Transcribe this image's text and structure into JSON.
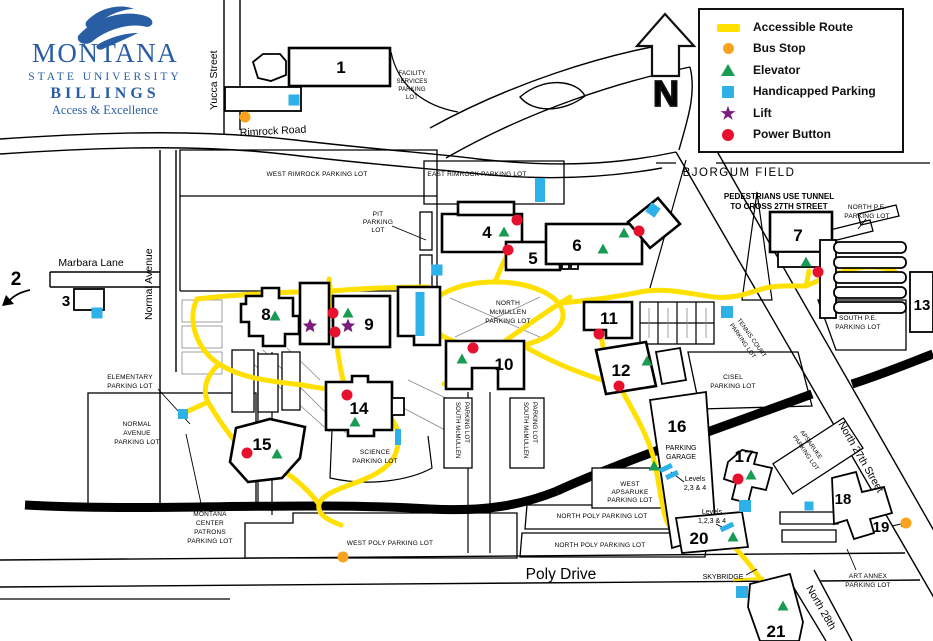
{
  "colors": {
    "route_yellow": "#FFE000",
    "bus_orange": "#F7A31C",
    "elevator_green": "#1A9B53",
    "handicap_blue": "#2EB1E8",
    "lift_purple": "#7A1B7E",
    "power_red": "#E8112D",
    "logo_blue": "#2A5EA4"
  },
  "logo": {
    "line1": "MONTANA",
    "line2": "STATE UNIVERSITY",
    "line3": "BILLINGS",
    "tagline": "Access & Excellence"
  },
  "compass": {
    "label": "N"
  },
  "legend": {
    "items": [
      {
        "icon": "accessible-route-swatch",
        "label": "Accessible Route"
      },
      {
        "icon": "bus-stop-dot",
        "label": "Bus Stop"
      },
      {
        "icon": "elevator-triangle",
        "label": "Elevator"
      },
      {
        "icon": "handicapped-parking-square",
        "label": "Handicapped Parking"
      },
      {
        "icon": "lift-star",
        "label": "Lift"
      },
      {
        "icon": "power-button-dot",
        "label": "Power Button"
      }
    ]
  },
  "streets": {
    "yucca": "Yucca Street",
    "rimrock": "Rimrock Road",
    "normal": "Normal Avenue",
    "marbara": "Marbara Lane",
    "poly": "Poly Drive",
    "n27": "North 27th Street",
    "n28": "North 28th"
  },
  "labels": {
    "bjorgum": "BJORGUM FIELD",
    "tunnel": [
      "PEDESTRIANS USE TUNNEL",
      "TO CROSS 27TH STREET"
    ],
    "skybridge": "SKYBRIDGE",
    "garage": [
      "PARKING",
      "GARAGE"
    ],
    "levels234": [
      "Levels",
      "2,3 & 4"
    ],
    "levels1234": [
      "Levels",
      "1,2,3 & 4"
    ]
  },
  "lots": {
    "west_rimrock": [
      "WEST RIMROCK PARKING LOT"
    ],
    "east_rimrock": [
      "EAST RIMROCK PARKING LOT"
    ],
    "facility": [
      "FACILITY",
      "SERVICES",
      "PARKING",
      "LOT"
    ],
    "pit": [
      "PIT",
      "PARKING",
      "LOT"
    ],
    "north_pe": [
      "NORTH P.E.",
      "PARKING LOT"
    ],
    "south_pe": [
      "SOUTH P.E.",
      "PARKING LOT"
    ],
    "north_mcmullen": [
      "NORTH",
      "McMULLEN",
      "PARKING LOT"
    ],
    "south_mcmullen": [
      "SOUTH McMULLEN",
      "PARKING LOT"
    ],
    "elementary": [
      "ELEMENTARY",
      "PARKING LOT"
    ],
    "normal_avenue": [
      "NORMAL",
      "AVENUE",
      "PARKING LOT"
    ],
    "science": [
      "SCIENCE",
      "PARKING LOT"
    ],
    "montana_center": [
      "MONTANA",
      "CENTER",
      "PATRONS",
      "PARKING LOT"
    ],
    "west_poly": [
      "WEST POLY PARKING LOT"
    ],
    "north_poly": [
      "NORTH POLY PARKING LOT"
    ],
    "cisel": [
      "CISEL",
      "PARKING LOT"
    ],
    "tennis": [
      "TENNIS COURT",
      "PARKING LOT"
    ],
    "west_apsaruke": [
      "WEST",
      "APSARUKE",
      "PARKING LOT"
    ],
    "apsaruke": [
      "APSARUKE",
      "PARKING LOT"
    ],
    "art_annex": [
      "ART ANNEX",
      "PARKING LOT"
    ]
  },
  "buildings": {
    "b1": "1",
    "b2": "2",
    "b3": "3",
    "b4": "4",
    "b5": "5",
    "b6": "6",
    "b7": "7",
    "b8": "8",
    "b9": "9",
    "b10": "10",
    "b11": "11",
    "b12": "12",
    "b13": "13",
    "b14": "14",
    "b15": "15",
    "b16": "16",
    "b17": "17",
    "b18": "18",
    "b19": "19",
    "b20": "20",
    "b21": "21"
  },
  "markers": [
    [
      "bus-stop",
      245,
      117
    ],
    [
      "bus-stop",
      343,
      557
    ],
    [
      "bus-stop",
      906,
      523
    ],
    [
      "power-button",
      517,
      220
    ],
    [
      "power-button",
      508,
      250
    ],
    [
      "power-button",
      639,
      231
    ],
    [
      "power-button",
      818,
      272
    ],
    [
      "power-button",
      333,
      313
    ],
    [
      "power-button",
      335,
      332
    ],
    [
      "power-button",
      473,
      348
    ],
    [
      "power-button",
      599,
      334
    ],
    [
      "power-button",
      619,
      386
    ],
    [
      "power-button",
      347,
      395
    ],
    [
      "power-button",
      247,
      453
    ],
    [
      "power-button",
      738,
      479
    ],
    [
      "elevator",
      275,
      316
    ],
    [
      "elevator",
      348,
      313
    ],
    [
      "elevator",
      504,
      232
    ],
    [
      "elevator",
      603,
      249
    ],
    [
      "elevator",
      624,
      233
    ],
    [
      "elevator",
      806,
      262
    ],
    [
      "elevator",
      462,
      359
    ],
    [
      "elevator",
      647,
      361
    ],
    [
      "elevator",
      355,
      422
    ],
    [
      "elevator",
      277,
      454
    ],
    [
      "elevator",
      654,
      466
    ],
    [
      "elevator",
      751,
      475
    ],
    [
      "elevator",
      733,
      537
    ],
    [
      "elevator",
      783,
      606
    ],
    [
      "lift",
      310,
      326
    ],
    [
      "lift",
      348,
      326
    ],
    [
      "handicapped-parking",
      294,
      100,
      11,
      11,
      0
    ],
    [
      "handicapped-parking",
      540,
      190,
      10,
      24,
      0
    ],
    [
      "handicapped-parking",
      653,
      210,
      11,
      11,
      35
    ],
    [
      "handicapped-parking",
      437,
      270,
      11,
      11,
      0
    ],
    [
      "handicapped-parking",
      97,
      313,
      11,
      11,
      0
    ],
    [
      "handicapped-parking",
      420,
      314,
      9,
      44,
      0
    ],
    [
      "handicapped-parking",
      727,
      312,
      12,
      12,
      0
    ],
    [
      "handicapped-parking",
      183,
      414,
      10,
      10,
      0
    ],
    [
      "handicapped-parking",
      398,
      437,
      6,
      16,
      0
    ],
    [
      "handicapped-parking",
      666,
      468,
      13,
      5,
      -25
    ],
    [
      "handicapped-parking",
      672,
      475,
      13,
      5,
      -25
    ],
    [
      "handicapped-parking",
      727,
      527,
      14,
      5,
      -25
    ],
    [
      "handicapped-parking",
      745,
      506,
      12,
      12,
      0
    ],
    [
      "handicapped-parking",
      809,
      506,
      9,
      9,
      0
    ],
    [
      "handicapped-parking",
      742,
      592,
      12,
      12,
      0
    ]
  ]
}
